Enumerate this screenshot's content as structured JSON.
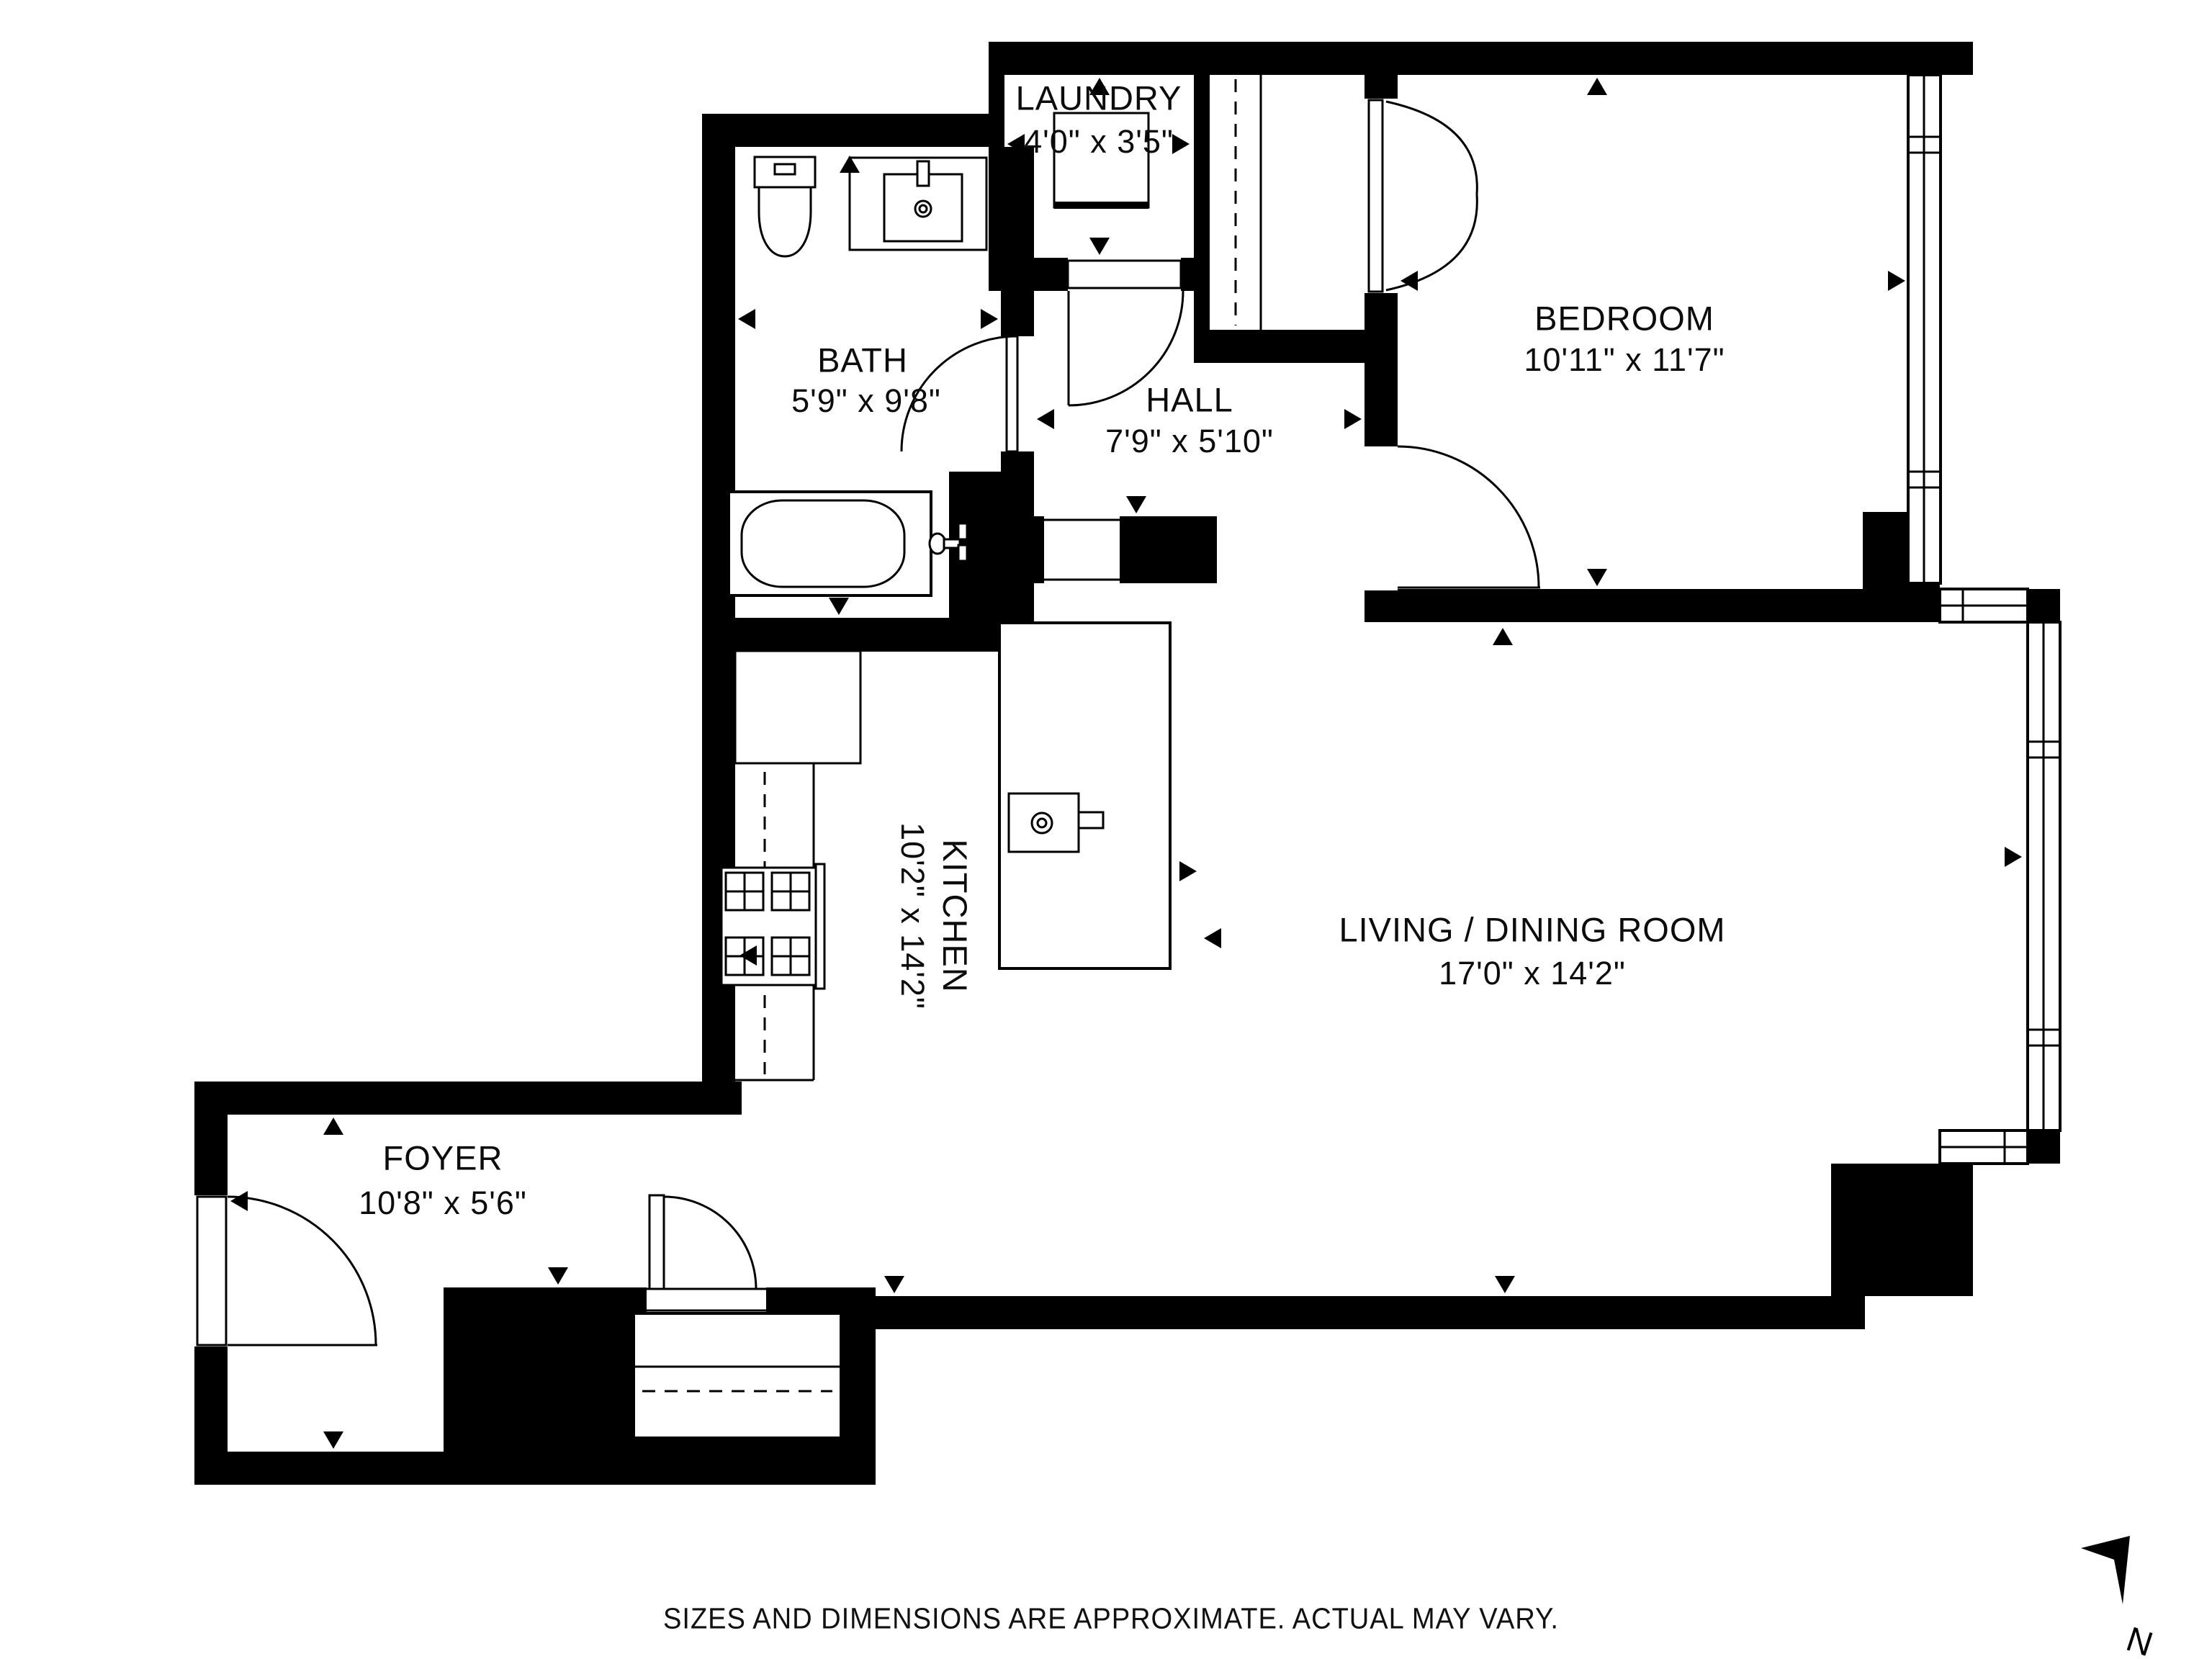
{
  "palette": {
    "ink": "#000000",
    "background": "#ffffff"
  },
  "rooms": [
    {
      "id": "laundry",
      "name": "LAUNDRY",
      "dims": "4'0\" x 3'5\""
    },
    {
      "id": "bath",
      "name": "BATH",
      "dims": "5'9\" x 9'8\""
    },
    {
      "id": "hall",
      "name": "HALL",
      "dims": "7'9\" x 5'10\""
    },
    {
      "id": "bedroom",
      "name": "BEDROOM",
      "dims": "10'11\" x 11'7\""
    },
    {
      "id": "kitchen",
      "name": "KITCHEN",
      "dims": "10'2\" x 14'2\""
    },
    {
      "id": "living",
      "name": "LIVING / DINING ROOM",
      "dims": "17'0\" x 14'2\""
    },
    {
      "id": "foyer",
      "name": "FOYER",
      "dims": "10'8\" x 5'6\""
    }
  ],
  "footer": {
    "disclaimer": "SIZES AND DIMENSIONS ARE APPROXIMATE. ACTUAL MAY VARY."
  },
  "compass": {
    "label": "N"
  }
}
